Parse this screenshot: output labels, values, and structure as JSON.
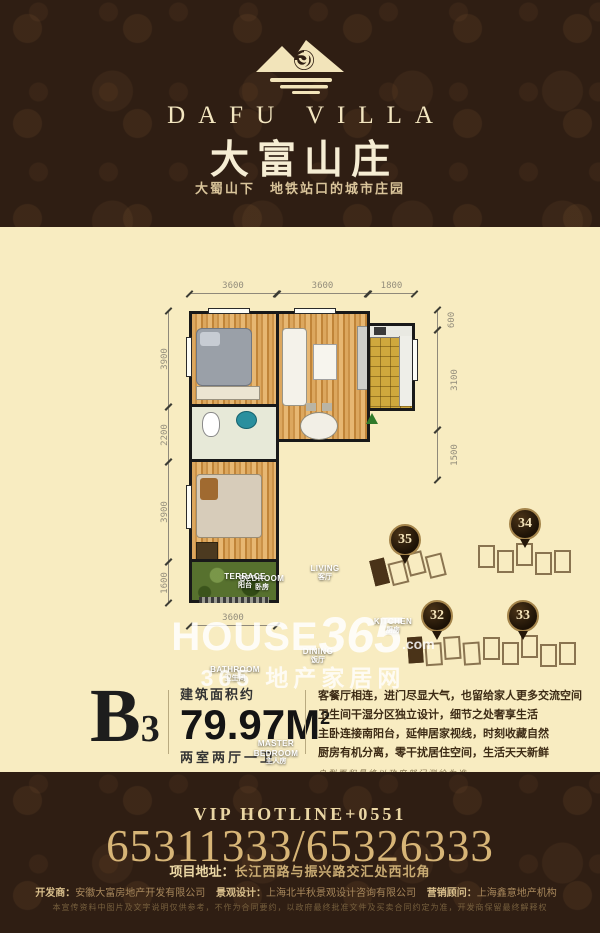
{
  "header": {
    "brand_en": "DAFU VILLA",
    "brand_cn": "大富山庄",
    "tagline": "大蜀山下　地铁站口的城市庄园"
  },
  "floorplan": {
    "dims_top": [
      "3600",
      "3600",
      "1800"
    ],
    "dims_left": [
      "3900",
      "2200",
      "3900",
      "1600"
    ],
    "dims_right": [
      "600",
      "3100",
      "1500"
    ],
    "dims_bottom": [
      "3600"
    ],
    "rooms": [
      {
        "en": "BEDROOM",
        "cn": "卧房"
      },
      {
        "en": "LIVING",
        "cn": "客厅"
      },
      {
        "en": "KITCHEN",
        "cn": "厨房"
      },
      {
        "en": "BATHROOM",
        "cn": "卫生间"
      },
      {
        "en": "DINING",
        "cn": "饭厅"
      },
      {
        "en": "MASTER BEDROOM",
        "cn": "主人房"
      },
      {
        "en": "TERRACE",
        "cn": "阳台"
      }
    ]
  },
  "site_map": {
    "buildings": [
      {
        "no": "35"
      },
      {
        "no": "34"
      },
      {
        "no": "32"
      },
      {
        "no": "33"
      }
    ]
  },
  "watermark": {
    "part_house": "HOUSE",
    "part_365": "365",
    "part_com": ".com",
    "line2": "365 地产家居网"
  },
  "unit": {
    "code_letter": "B",
    "code_number": "3",
    "area_label": "建筑面积约",
    "area_value": "79.97M",
    "area_sup": "2",
    "layout": "两室两厅一卫",
    "desc_lines": [
      "客餐厅相连，进门尽显大气，也留给家人更多交流空间",
      "卫生间干湿分区独立设计，细节之处奢享生活",
      "主卧连接南阳台，延伸居家视线，时刻收藏自然",
      "厨房有机分离，零干扰居住空间，生活天天新鲜"
    ],
    "note": "户型面积最终以政府部门测绘为准"
  },
  "footer": {
    "hotline_label": "VIP HOTLINE+0551",
    "phones": "65311333/65326333",
    "address_label": "项目地址：",
    "address_value": "长江西路与振兴路交汇处西北角",
    "credit1_label": "开发商：",
    "credit1_value": "安徽大富房地产开发有限公司",
    "credit2_label": "景观设计：",
    "credit2_value": "上海北半秋景观设计咨询有限公司",
    "credit3_label": "营销顾问：",
    "credit3_value": "上海鑫意地产机构",
    "disclaimer": "本宣传资料中图片及文字说明仅供参考，不作为合同要约，以政府最终批准文件及买卖合同约定为准，开发商保留最终解释权"
  }
}
